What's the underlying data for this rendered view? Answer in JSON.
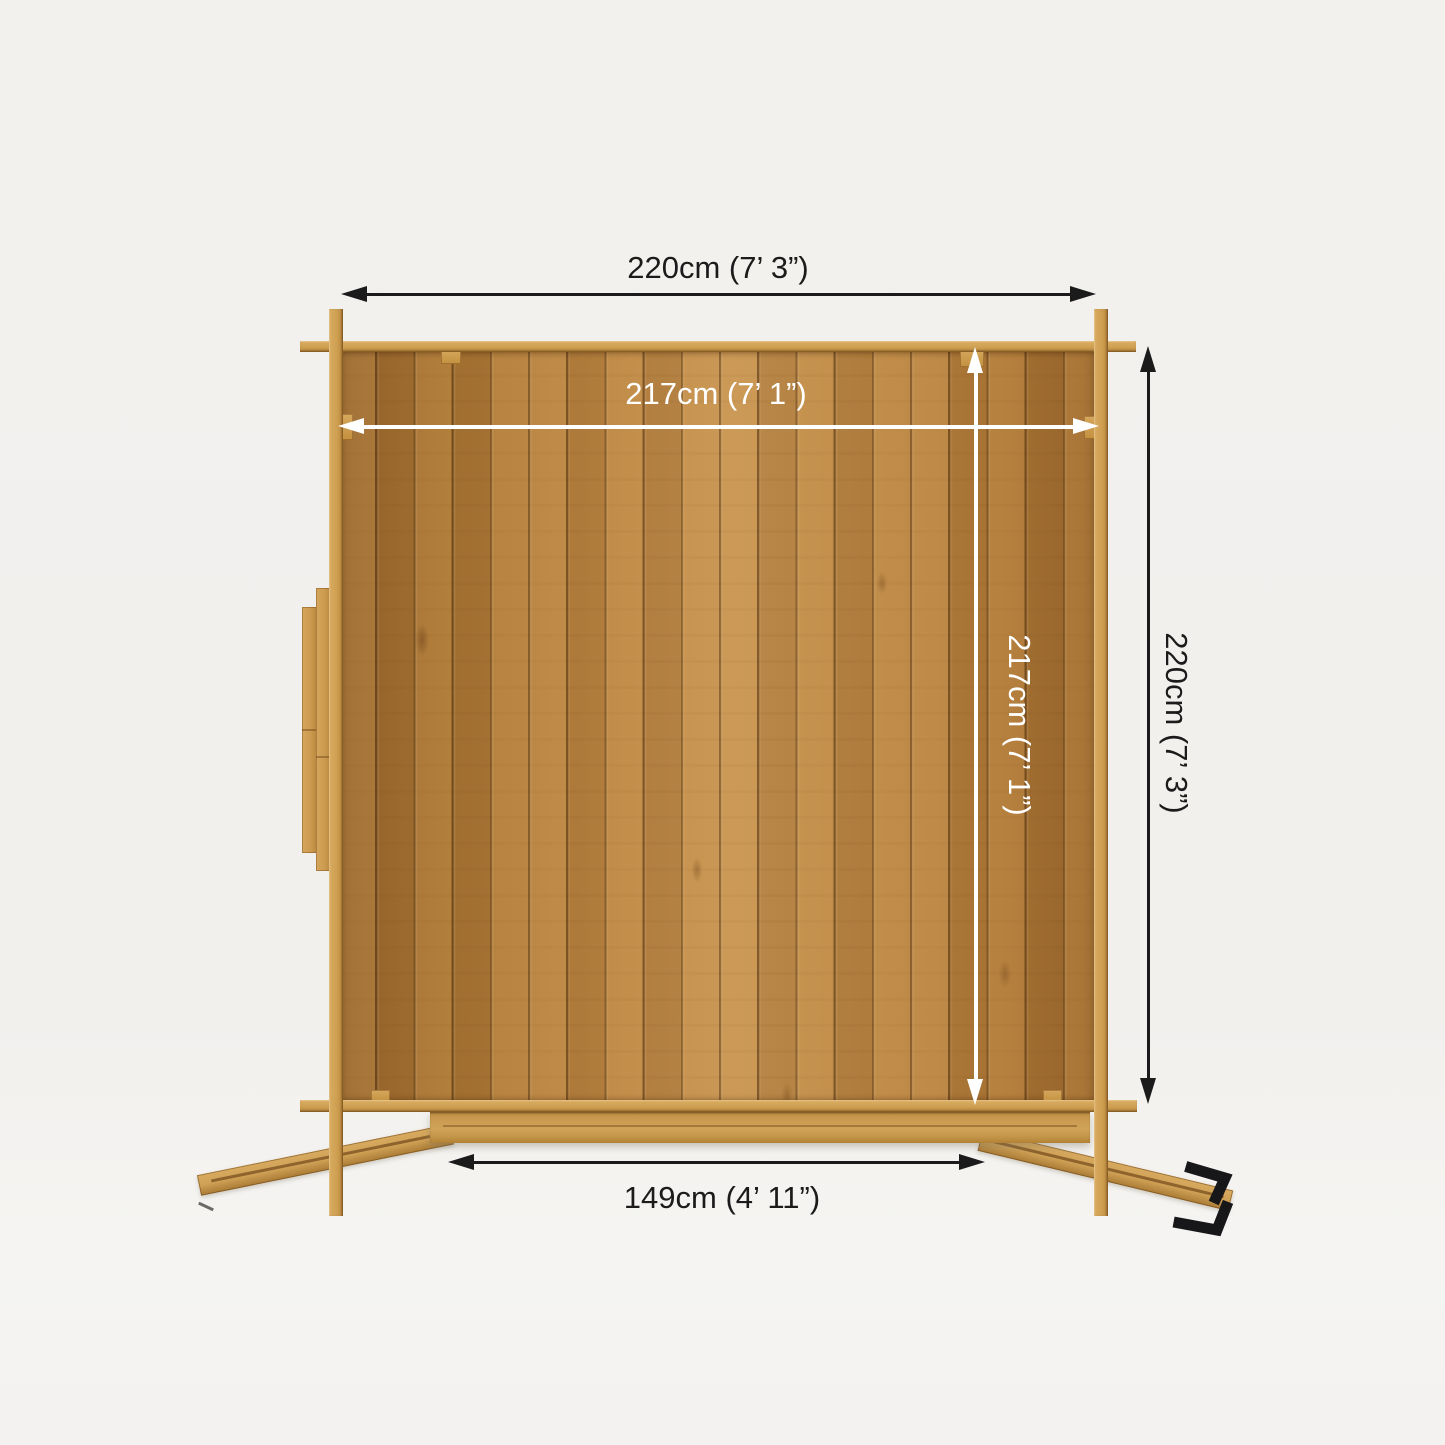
{
  "image": {
    "type": "Product dimension diagram — overhead plan view of a square timber log cabin with open double doors",
    "background_color": "#f3f1ee"
  },
  "labels": {
    "external_width": "220cm (7’ 3”)",
    "internal_width": "217cm (7’ 1”)",
    "internal_depth": "217cm (7’ 1”)",
    "external_depth": "220cm (7’ 3”)",
    "door_opening_width": "149cm (4’ 11”)"
  },
  "colors": {
    "dimension_black": "#1b1b1b",
    "dimension_white": "#ffffff",
    "timber_light": "#d3a65c",
    "timber_panel": "#b5813c"
  },
  "icons": {
    "door_handles": "black-door-handles"
  }
}
